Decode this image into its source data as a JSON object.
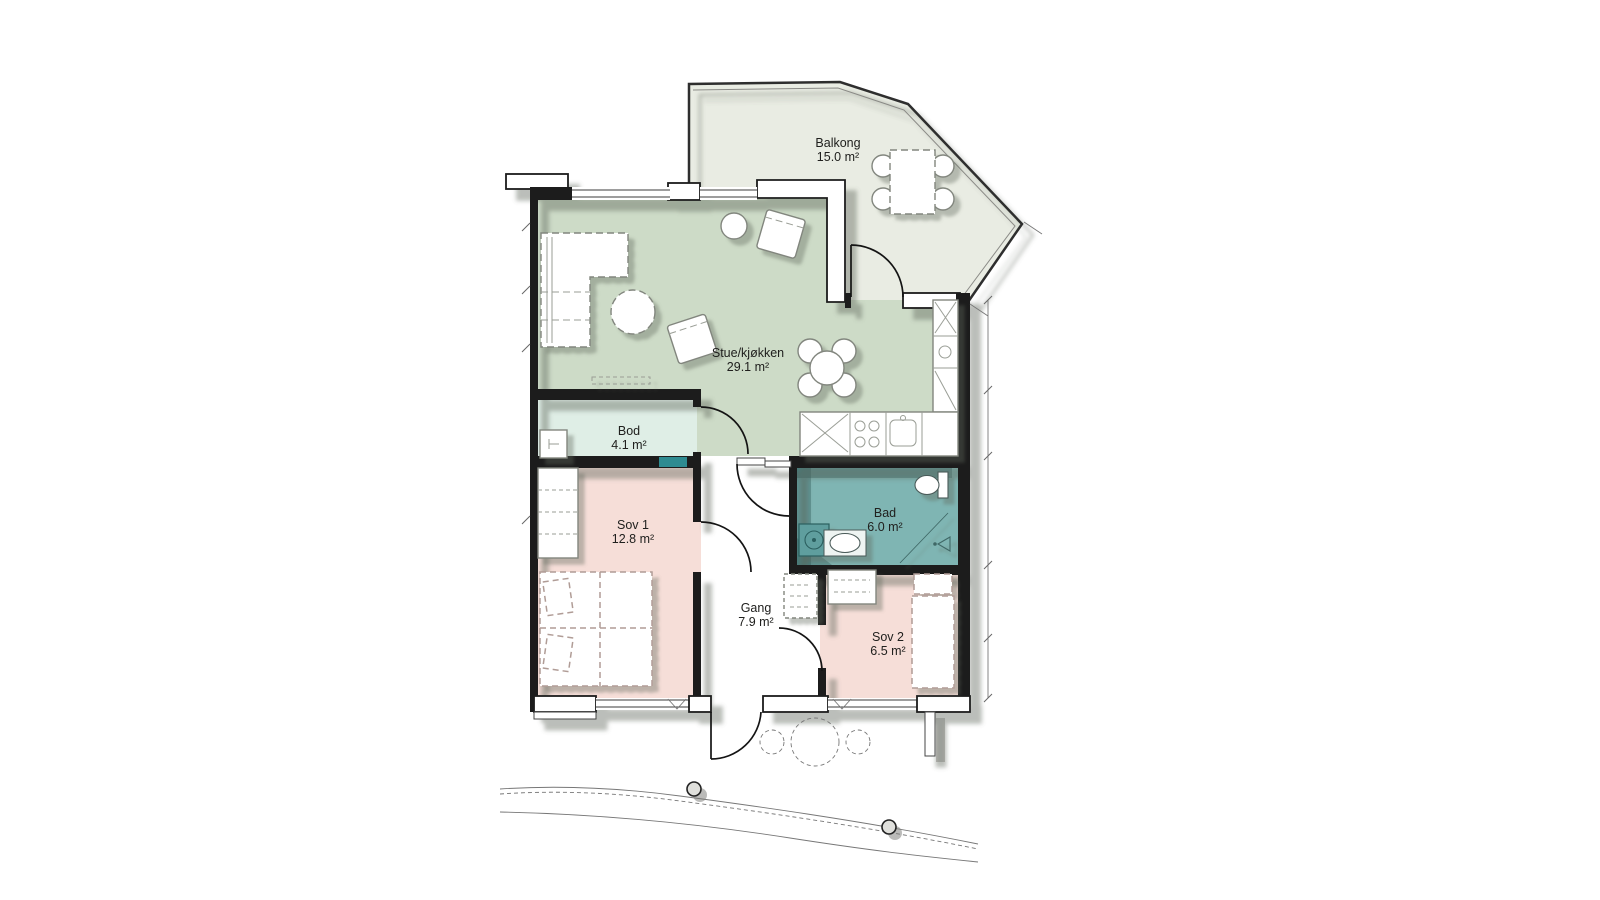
{
  "colors": {
    "canvas": "#ffffff",
    "living": "#cddbc7",
    "bod": "#dfeee6",
    "balcony": "#e9ece3",
    "bath": "#7fb5b3",
    "bath_shadow": "rgba(30,75,75,0.33)",
    "bedroom": "#f6ded8",
    "hall": "#ffffff",
    "wall": "#1c1c1c",
    "accent_teal": "#2f8b91",
    "shadow": "#5f655c"
  },
  "rooms": {
    "balkong": {
      "name": "Balkong",
      "area": "15.0 m²"
    },
    "stue": {
      "name": "Stue/kjøkken",
      "area": "29.1 m²"
    },
    "bod": {
      "name": "Bod",
      "area": "4.1 m²"
    },
    "sov1": {
      "name": "Sov 1",
      "area": "12.8 m²"
    },
    "bad": {
      "name": "Bad",
      "area": "6.0 m²"
    },
    "gang": {
      "name": "Gang",
      "area": "7.9 m²"
    },
    "sov2": {
      "name": "Sov 2",
      "area": "6.5 m²"
    }
  }
}
